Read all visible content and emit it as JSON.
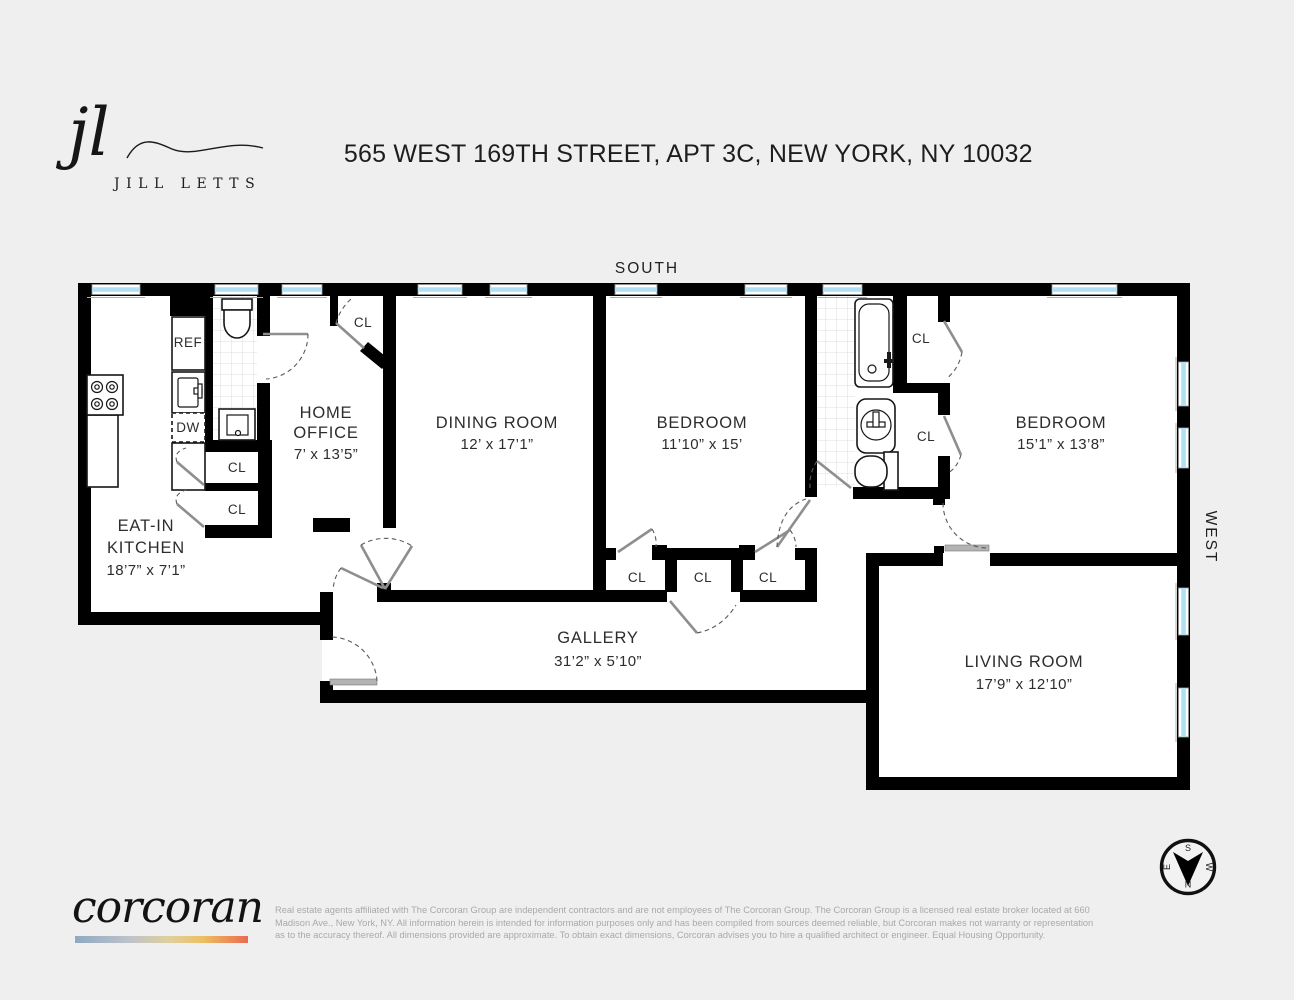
{
  "brand": {
    "agent_logo": "jl",
    "agent_name": "JILL LETTS",
    "brokerage": "corcoran",
    "gradient_colors": [
      "#8FA9C2",
      "#BFC3C9",
      "#DFD09C",
      "#ECBF63",
      "#EC6A52"
    ],
    "window_color": "#AEDFF2",
    "wall_color": "#000000"
  },
  "title": "565 WEST 169TH STREET, APT 3C, NEW YORK, NY 10032",
  "orientation": {
    "top": "SOUTH",
    "right": "WEST"
  },
  "compass": {
    "n": "N",
    "s": "S",
    "e": "E",
    "w": "W"
  },
  "rooms": {
    "kitchen": {
      "line1": "EAT-IN",
      "line2": "KITCHEN",
      "dims": "18’7” x 7’1”"
    },
    "office": {
      "line1": "HOME",
      "line2": "OFFICE",
      "dims": "7’ x 13’5”"
    },
    "dining": {
      "name": "DINING ROOM",
      "dims": "12’ x 17’1”"
    },
    "bedroom1": {
      "name": "BEDROOM",
      "dims": "11’10” x 15’"
    },
    "bedroom2": {
      "name": "BEDROOM",
      "dims": "15’1” x 13’8”"
    },
    "gallery": {
      "name": "GALLERY",
      "dims": "31’2” x 5’10”"
    },
    "living": {
      "name": "LIVING ROOM",
      "dims": "17’9” x 12’10”"
    }
  },
  "fixtures": {
    "refrigerator": "REF",
    "dishwasher": "DW",
    "closet": "CL"
  },
  "footer": {
    "disclaimer_line1": "Real estate agents affiliated with The Corcoran Group are independent contractors and are not employees of The Corcoran Group. The Corcoran Group is a licensed real estate broker located at 660",
    "disclaimer_line2": "Madison Ave., New York, NY. All information herein is intended for information purposes only and has been compiled from sources deemed reliable, but Corcoran makes not warranty or representation",
    "disclaimer_line3": "as to the accuracy thereof. All dimensions provided are approximate. To obtain exact dimensions, Corcoran advises you to hire a qualified architect or engineer. Equal Housing Opportunity."
  }
}
